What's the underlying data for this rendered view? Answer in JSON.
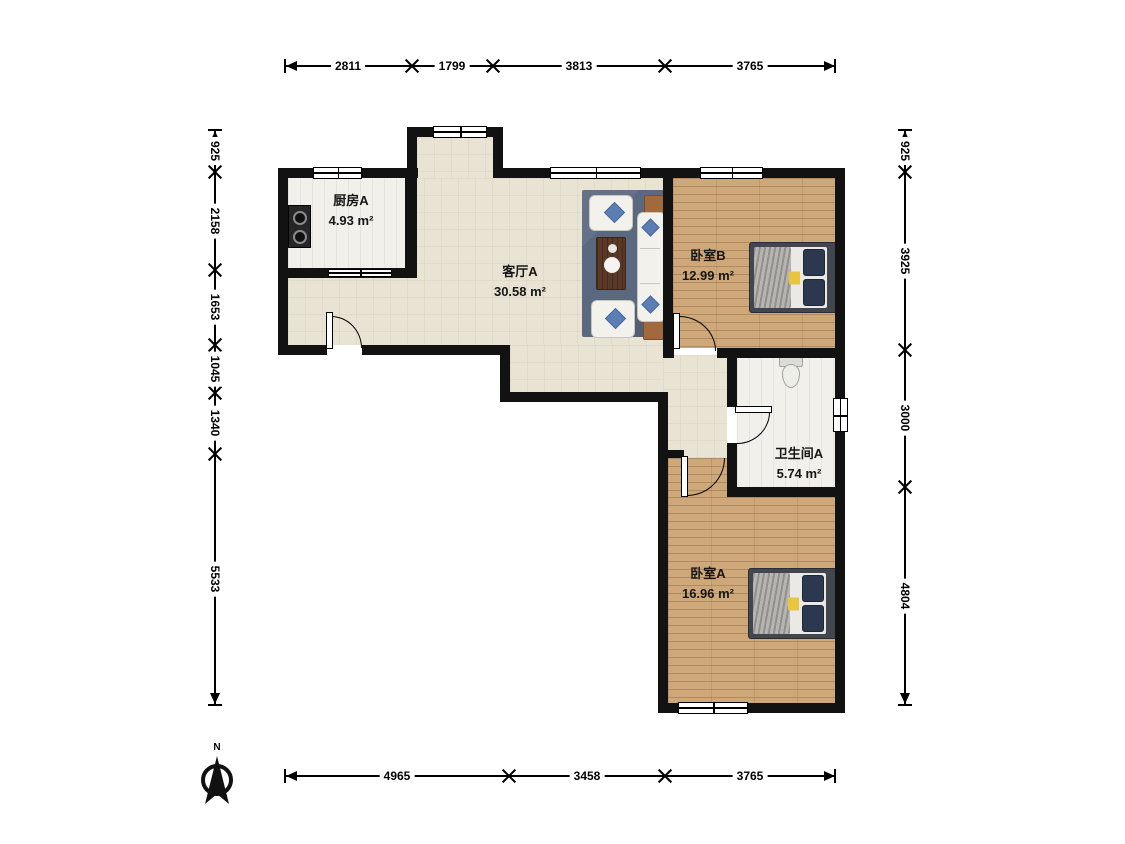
{
  "compass": {
    "label": "N"
  },
  "rooms": {
    "kitchen": {
      "name": "厨房A",
      "area": "4.93 m²"
    },
    "living": {
      "name": "客厅A",
      "area": "30.58 m²"
    },
    "bedroom_b": {
      "name": "卧室B",
      "area": "12.99 m²"
    },
    "bathroom": {
      "name": "卫生间A",
      "area": "5.74 m²"
    },
    "bedroom_a": {
      "name": "卧室A",
      "area": "16.96 m²"
    }
  },
  "dimensions": {
    "top": [
      "2811",
      "1799",
      "3813",
      "3765"
    ],
    "bottom": [
      "4965",
      "3458",
      "3765"
    ],
    "left": [
      "925",
      "2158",
      "1653",
      "1045",
      "1340",
      "5533"
    ],
    "right": [
      "925",
      "3925",
      "3000",
      "4804"
    ]
  },
  "colors": {
    "wall": "#121212",
    "living_floor": "#e9e3d4",
    "wood_floor": "#cfa87a",
    "tile_floor": "#f1f0ea",
    "rug": "#5a6880",
    "accent_pillow": "#5b7fb5"
  }
}
